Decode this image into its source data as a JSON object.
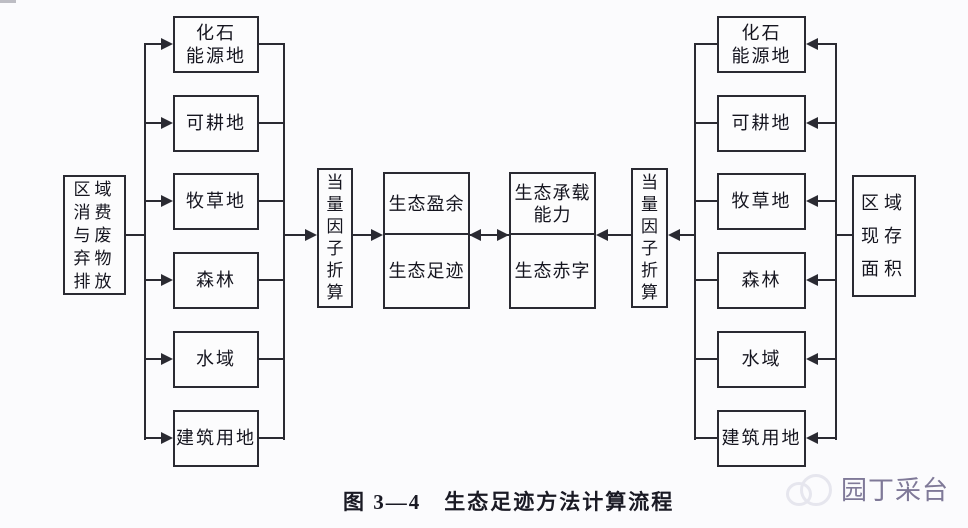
{
  "caption": {
    "text": "图 3—4　生态足迹方法计算流程"
  },
  "left": {
    "source": "区域\n消费\n与废\n弃物\n排放",
    "converter": "当\n量\n因\n子\n折\n算",
    "land": [
      "化石\n能源地",
      "可耕地",
      "牧草地",
      "森林",
      "水域",
      "建筑用地"
    ]
  },
  "center": {
    "surplus": "生态盈余",
    "footprint": "生态足迹",
    "capacity": "生态承载\n能力",
    "deficit": "生态赤字"
  },
  "right": {
    "source": "区域\n现存\n面积",
    "converter": "当\n量\n因\n子\n折\n算",
    "land": [
      "化石\n能源地",
      "可耕地",
      "牧草地",
      "森林",
      "水域",
      "建筑用地"
    ]
  },
  "watermark": {
    "text": "园丁采台"
  },
  "colors": {
    "line": "#2a2a32",
    "text": "#15151f",
    "background": "#fbfbfd",
    "watermark_text": "#686286",
    "watermark_logo": "#e6e6ee"
  }
}
